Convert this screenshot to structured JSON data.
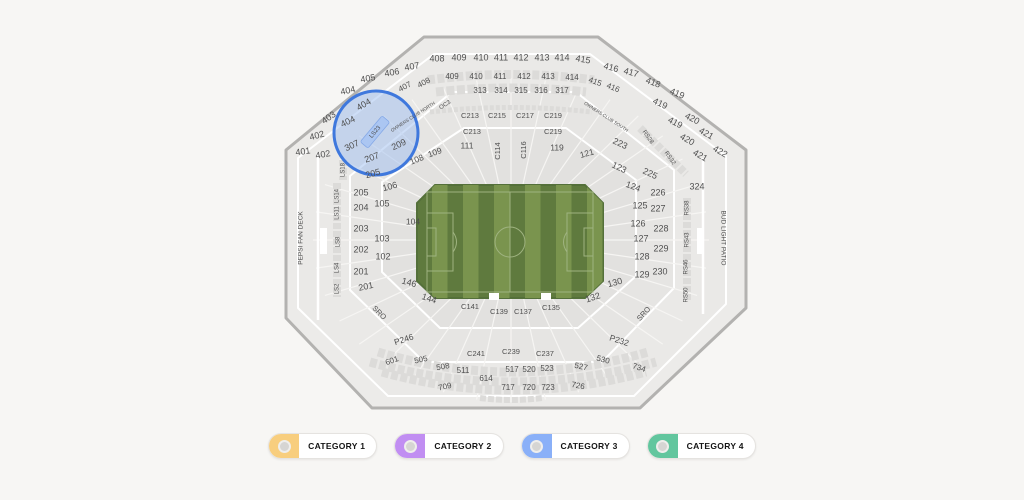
{
  "colors": {
    "page_bg": "#f7f6f4",
    "stadium_fill": "#ECEBE9",
    "stadium_border": "#B3B2B0",
    "ring_a": "#EAE9E7",
    "ring_b": "#E6E5E3",
    "ring_c": "#E2E1DF",
    "divider": "#F6F5F3",
    "band": "#DCDBD9",
    "field_dark": "#5F7A3E",
    "field_light": "#7A944E",
    "field_line": "#9FB380",
    "highlight_stroke": "#3F78DD",
    "highlight_fill": "#9DBDF0",
    "ls23_band": "#B9CEF4",
    "ls23_text": "#2A4C9F",
    "label_text": "#4F4F4F"
  },
  "legend": {
    "items": [
      {
        "label": "CATEGORY 1",
        "color": "#F8CE7E"
      },
      {
        "label": "CATEGORY 2",
        "color": "#C18EF2"
      },
      {
        "label": "CATEGORY 3",
        "color": "#8AB0F8"
      },
      {
        "label": "CATEGORY 4",
        "color": "#62C69E"
      }
    ]
  },
  "map": {
    "highlighted_sections": [
      "404",
      "307",
      "207",
      "209",
      "205",
      "LS23"
    ],
    "labels": [
      {
        "t": "401",
        "x": 303,
        "y": 152,
        "r": -8
      },
      {
        "t": "402",
        "x": 317,
        "y": 136,
        "r": -15
      },
      {
        "t": "403",
        "x": 329,
        "y": 118,
        "r": -35
      },
      {
        "t": "404",
        "x": 348,
        "y": 91,
        "r": -12
      },
      {
        "t": "404",
        "x": 364,
        "y": 105,
        "r": -30
      },
      {
        "t": "404",
        "x": 348,
        "y": 122,
        "r": -25
      },
      {
        "t": "402",
        "x": 323,
        "y": 155,
        "r": -10
      },
      {
        "t": "405",
        "x": 368,
        "y": 79,
        "r": -10
      },
      {
        "t": "406",
        "x": 392,
        "y": 73,
        "r": -10
      },
      {
        "t": "407",
        "x": 412,
        "y": 67,
        "r": -10
      },
      {
        "t": "407",
        "x": 405,
        "y": 87,
        "r": -28,
        "s": 8
      },
      {
        "t": "408",
        "x": 437,
        "y": 59
      },
      {
        "t": "408",
        "x": 424,
        "y": 83,
        "r": -28,
        "s": 8
      },
      {
        "t": "409",
        "x": 459,
        "y": 58
      },
      {
        "t": "410",
        "x": 481,
        "y": 58
      },
      {
        "t": "411",
        "x": 501,
        "y": 58
      },
      {
        "t": "412",
        "x": 521,
        "y": 58
      },
      {
        "t": "413",
        "x": 542,
        "y": 58
      },
      {
        "t": "414",
        "x": 562,
        "y": 58
      },
      {
        "t": "409",
        "x": 452,
        "y": 77,
        "s": 8
      },
      {
        "t": "410",
        "x": 476,
        "y": 77,
        "s": 8
      },
      {
        "t": "411",
        "x": 500,
        "y": 77,
        "s": 8
      },
      {
        "t": "412",
        "x": 524,
        "y": 77,
        "s": 8
      },
      {
        "t": "413",
        "x": 548,
        "y": 77,
        "s": 8
      },
      {
        "t": "414",
        "x": 572,
        "y": 78,
        "s": 8
      },
      {
        "t": "415",
        "x": 583,
        "y": 60,
        "r": 10
      },
      {
        "t": "416",
        "x": 611,
        "y": 68,
        "r": 15
      },
      {
        "t": "417",
        "x": 631,
        "y": 73,
        "r": 15
      },
      {
        "t": "418",
        "x": 653,
        "y": 83,
        "r": 20
      },
      {
        "t": "415",
        "x": 595,
        "y": 82,
        "r": 20,
        "s": 8
      },
      {
        "t": "416",
        "x": 613,
        "y": 88,
        "r": 22,
        "s": 8
      },
      {
        "t": "419",
        "x": 677,
        "y": 94,
        "r": 22
      },
      {
        "t": "419",
        "x": 660,
        "y": 104,
        "r": 25
      },
      {
        "t": "419",
        "x": 675,
        "y": 123,
        "r": 28
      },
      {
        "t": "420",
        "x": 692,
        "y": 119,
        "r": 28
      },
      {
        "t": "420",
        "x": 687,
        "y": 140,
        "r": 30
      },
      {
        "t": "421",
        "x": 706,
        "y": 134,
        "r": 30
      },
      {
        "t": "421",
        "x": 700,
        "y": 156,
        "r": 30
      },
      {
        "t": "422",
        "x": 720,
        "y": 152,
        "r": 30
      },
      {
        "t": "313",
        "x": 480,
        "y": 91,
        "s": 8
      },
      {
        "t": "314",
        "x": 501,
        "y": 91,
        "s": 8
      },
      {
        "t": "315",
        "x": 521,
        "y": 91,
        "s": 8
      },
      {
        "t": "316",
        "x": 541,
        "y": 91,
        "s": 8
      },
      {
        "t": "317",
        "x": 562,
        "y": 91,
        "s": 8
      },
      {
        "t": "OC3",
        "x": 445,
        "y": 105,
        "r": -33,
        "s": 6
      },
      {
        "t": "OWNERS CLUB NORTH",
        "x": 413,
        "y": 117,
        "r": -33,
        "s": 4.6
      },
      {
        "t": "OWNERS CLUB SOUTH",
        "x": 606,
        "y": 117,
        "r": 33,
        "s": 4.6
      },
      {
        "t": "RS28",
        "x": 648,
        "y": 137,
        "r": 55,
        "s": 6
      },
      {
        "t": "RS32",
        "x": 670,
        "y": 158,
        "r": 55,
        "s": 6
      },
      {
        "t": "C213",
        "x": 470,
        "y": 116,
        "s": 7.5
      },
      {
        "t": "C215",
        "x": 497,
        "y": 116,
        "s": 7.5
      },
      {
        "t": "C217",
        "x": 525,
        "y": 116,
        "s": 7.5
      },
      {
        "t": "C219",
        "x": 553,
        "y": 116,
        "s": 7.5
      },
      {
        "t": "C213",
        "x": 472,
        "y": 132,
        "s": 7.5
      },
      {
        "t": "C219",
        "x": 553,
        "y": 132,
        "s": 7.5
      },
      {
        "t": "LS23",
        "x": 375,
        "y": 132,
        "r": -50,
        "s": 6,
        "c": "#2A4C9F"
      },
      {
        "t": "307",
        "x": 352,
        "y": 146,
        "r": -25
      },
      {
        "t": "209",
        "x": 399,
        "y": 145,
        "r": -25
      },
      {
        "t": "207",
        "x": 372,
        "y": 158,
        "r": -20
      },
      {
        "t": "205",
        "x": 373,
        "y": 174,
        "r": -15
      },
      {
        "t": "111",
        "x": 467,
        "y": 146,
        "s": 8.5
      },
      {
        "t": "C114",
        "x": 498,
        "y": 151,
        "r": -90,
        "s": 7.5
      },
      {
        "t": "C116",
        "x": 524,
        "y": 150,
        "r": -90,
        "s": 7.5
      },
      {
        "t": "119",
        "x": 557,
        "y": 148,
        "s": 8.5
      },
      {
        "t": "121",
        "x": 587,
        "y": 154,
        "r": -15,
        "s": 8.5
      },
      {
        "t": "223",
        "x": 620,
        "y": 144,
        "r": 25
      },
      {
        "t": "123",
        "x": 619,
        "y": 168,
        "r": 25
      },
      {
        "t": "124",
        "x": 633,
        "y": 187,
        "r": 20
      },
      {
        "t": "125",
        "x": 640,
        "y": 206
      },
      {
        "t": "126",
        "x": 638,
        "y": 224
      },
      {
        "t": "127",
        "x": 641,
        "y": 239
      },
      {
        "t": "128",
        "x": 642,
        "y": 257
      },
      {
        "t": "129",
        "x": 642,
        "y": 275
      },
      {
        "t": "130",
        "x": 615,
        "y": 283,
        "r": -15
      },
      {
        "t": "132",
        "x": 593,
        "y": 298,
        "r": -18
      },
      {
        "t": "225",
        "x": 650,
        "y": 174,
        "r": 25
      },
      {
        "t": "226",
        "x": 658,
        "y": 193
      },
      {
        "t": "227",
        "x": 658,
        "y": 209
      },
      {
        "t": "228",
        "x": 661,
        "y": 229
      },
      {
        "t": "229",
        "x": 661,
        "y": 249
      },
      {
        "t": "230",
        "x": 660,
        "y": 272
      },
      {
        "t": "324",
        "x": 697,
        "y": 187
      },
      {
        "t": "109",
        "x": 435,
        "y": 153,
        "r": -20,
        "s": 8.5
      },
      {
        "t": "108",
        "x": 417,
        "y": 160,
        "r": -22,
        "s": 8.5
      },
      {
        "t": "106",
        "x": 390,
        "y": 187,
        "r": -15
      },
      {
        "t": "105",
        "x": 382,
        "y": 204
      },
      {
        "t": "104",
        "x": 413,
        "y": 222,
        "s": 8.5
      },
      {
        "t": "103",
        "x": 382,
        "y": 239
      },
      {
        "t": "102",
        "x": 383,
        "y": 257
      },
      {
        "t": "146",
        "x": 409,
        "y": 283,
        "r": 15
      },
      {
        "t": "144",
        "x": 429,
        "y": 299,
        "r": 18
      },
      {
        "t": "205",
        "x": 361,
        "y": 193
      },
      {
        "t": "204",
        "x": 361,
        "y": 208
      },
      {
        "t": "203",
        "x": 361,
        "y": 229
      },
      {
        "t": "202",
        "x": 361,
        "y": 250
      },
      {
        "t": "201",
        "x": 361,
        "y": 272
      },
      {
        "t": "201",
        "x": 366,
        "y": 287,
        "r": -12
      },
      {
        "t": "LS18",
        "x": 343,
        "y": 170,
        "r": -90,
        "s": 6
      },
      {
        "t": "LS14",
        "x": 337,
        "y": 196,
        "r": -90,
        "s": 6
      },
      {
        "t": "LS11",
        "x": 337,
        "y": 213,
        "r": -90,
        "s": 6
      },
      {
        "t": "LS8",
        "x": 338,
        "y": 242,
        "r": -90,
        "s": 6
      },
      {
        "t": "LS4",
        "x": 337,
        "y": 268,
        "r": -90,
        "s": 6
      },
      {
        "t": "LS2",
        "x": 337,
        "y": 289,
        "r": -90,
        "s": 6
      },
      {
        "t": "RS38",
        "x": 687,
        "y": 208,
        "r": -90,
        "s": 6
      },
      {
        "t": "RS43",
        "x": 687,
        "y": 240,
        "r": -90,
        "s": 6
      },
      {
        "t": "RS46",
        "x": 686,
        "y": 267,
        "r": -90,
        "s": 6
      },
      {
        "t": "RS50",
        "x": 686,
        "y": 295,
        "r": -90,
        "s": 6
      },
      {
        "t": "PEPSI FAN DECK",
        "x": 301,
        "y": 238,
        "r": -90,
        "s": 6.5
      },
      {
        "t": "BUD LIGHT PATIO",
        "x": 723,
        "y": 238,
        "r": 90,
        "s": 6.5
      },
      {
        "t": "SRO",
        "x": 379,
        "y": 313,
        "r": 45,
        "s": 7.5
      },
      {
        "t": "SRO",
        "x": 644,
        "y": 314,
        "r": -48,
        "s": 7.5
      },
      {
        "t": "C141",
        "x": 470,
        "y": 307,
        "s": 7.5
      },
      {
        "t": "C139",
        "x": 499,
        "y": 312,
        "s": 7.5
      },
      {
        "t": "C137",
        "x": 523,
        "y": 312,
        "s": 7.5
      },
      {
        "t": "C135",
        "x": 551,
        "y": 308,
        "s": 7.5
      },
      {
        "t": "P246",
        "x": 404,
        "y": 340,
        "r": -18,
        "s": 8.5
      },
      {
        "t": "P232",
        "x": 619,
        "y": 341,
        "r": 18,
        "s": 8.5
      },
      {
        "t": "C241",
        "x": 476,
        "y": 354,
        "s": 7.5
      },
      {
        "t": "C239",
        "x": 511,
        "y": 352,
        "s": 7.5
      },
      {
        "t": "C237",
        "x": 545,
        "y": 354,
        "s": 7.5
      },
      {
        "t": "601",
        "x": 392,
        "y": 361,
        "r": -20,
        "s": 8
      },
      {
        "t": "505",
        "x": 421,
        "y": 360,
        "r": -12,
        "s": 8
      },
      {
        "t": "508",
        "x": 443,
        "y": 367,
        "r": -10,
        "s": 8
      },
      {
        "t": "511",
        "x": 463,
        "y": 371,
        "s": 8
      },
      {
        "t": "517",
        "x": 512,
        "y": 370,
        "s": 8
      },
      {
        "t": "520",
        "x": 529,
        "y": 370,
        "s": 8
      },
      {
        "t": "523",
        "x": 547,
        "y": 369,
        "s": 8
      },
      {
        "t": "527",
        "x": 581,
        "y": 367,
        "r": 12,
        "s": 8
      },
      {
        "t": "530",
        "x": 603,
        "y": 360,
        "r": 15,
        "s": 8
      },
      {
        "t": "734",
        "x": 639,
        "y": 368,
        "r": 18,
        "s": 8
      },
      {
        "t": "709",
        "x": 445,
        "y": 387,
        "r": -12,
        "s": 8
      },
      {
        "t": "614",
        "x": 486,
        "y": 379,
        "s": 8
      },
      {
        "t": "717",
        "x": 508,
        "y": 388,
        "s": 8
      },
      {
        "t": "720",
        "x": 529,
        "y": 388,
        "s": 8
      },
      {
        "t": "723",
        "x": 548,
        "y": 388,
        "s": 8
      },
      {
        "t": "726",
        "x": 578,
        "y": 386,
        "r": 10,
        "s": 8
      }
    ]
  }
}
